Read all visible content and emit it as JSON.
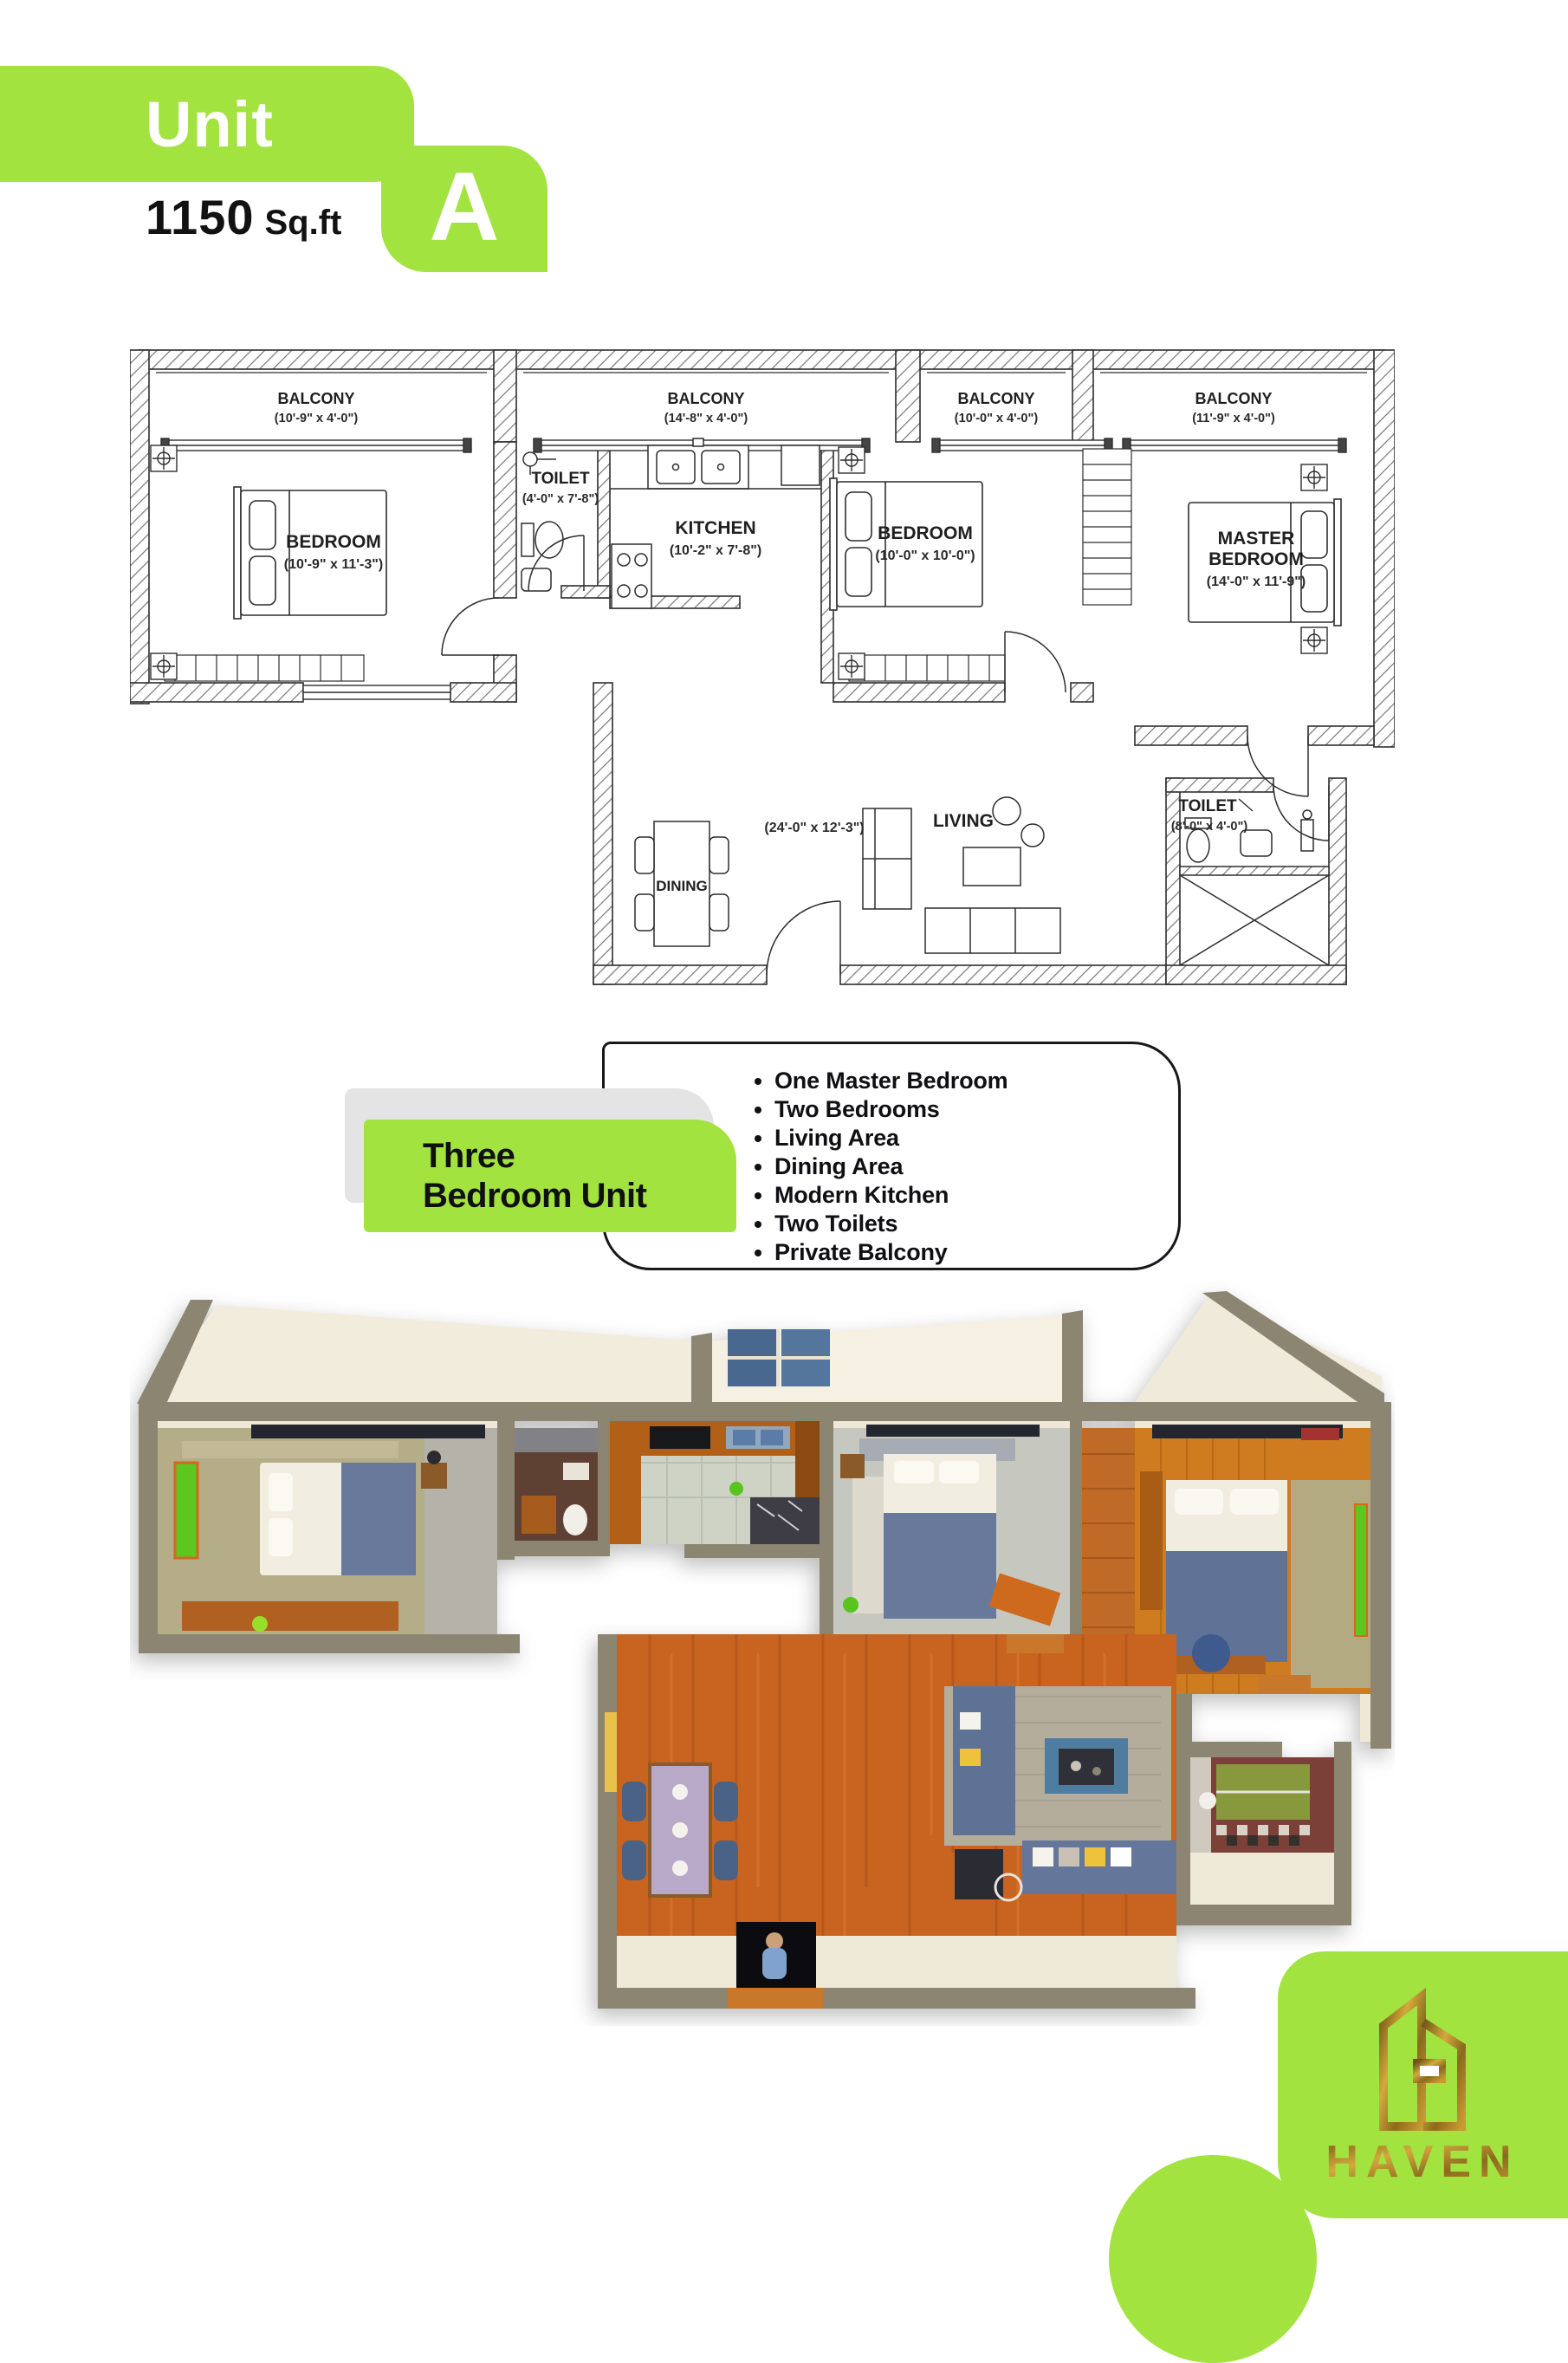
{
  "accent_color": "#a3e340",
  "gold_color": "#a9832b",
  "header": {
    "unit_label": "Unit",
    "area_value": "1150",
    "area_unit": "Sq.ft",
    "unit_letter": "A"
  },
  "floor_plan": {
    "balconies": [
      {
        "name": "BALCONY",
        "dims": "(10'-9\" x 4'-0\")"
      },
      {
        "name": "BALCONY",
        "dims": "(14'-8\" x 4'-0\")"
      },
      {
        "name": "BALCONY",
        "dims": "(10'-0\" x 4'-0\")"
      },
      {
        "name": "BALCONY",
        "dims": "(11'-9\" x 4'-0\")"
      }
    ],
    "rooms": {
      "bedroom1": {
        "name": "BEDROOM",
        "dims": "(10'-9\" x 11'-3\")"
      },
      "toilet1": {
        "name": "TOILET",
        "dims": "(4'-0\" x 7'-8\")"
      },
      "kitchen": {
        "name": "KITCHEN",
        "dims": "(10'-2\" x 7'-8\")"
      },
      "bedroom2": {
        "name": "BEDROOM",
        "dims": "(10'-0\" x 10'-0\")"
      },
      "master": {
        "name_line1": "MASTER",
        "name_line2": "BEDROOM",
        "dims": "(14'-0\" x 11'-9\")"
      },
      "living": {
        "name": "LIVING",
        "dims": "(24'-0\" x 12'-3\")"
      },
      "dining": {
        "name": "DINING"
      },
      "toilet2": {
        "name": "TOILET",
        "dims": "(8'-0\" x 4'-0\")"
      }
    }
  },
  "unit_info": {
    "title_line1": "Three",
    "title_line2": "Bedroom Unit",
    "features": [
      "One Master Bedroom",
      "Two Bedrooms",
      "Living Area",
      "Dining Area",
      "Modern Kitchen",
      "Two Toilets",
      "Private Balcony"
    ]
  },
  "brand": {
    "name": "HAVEN"
  }
}
